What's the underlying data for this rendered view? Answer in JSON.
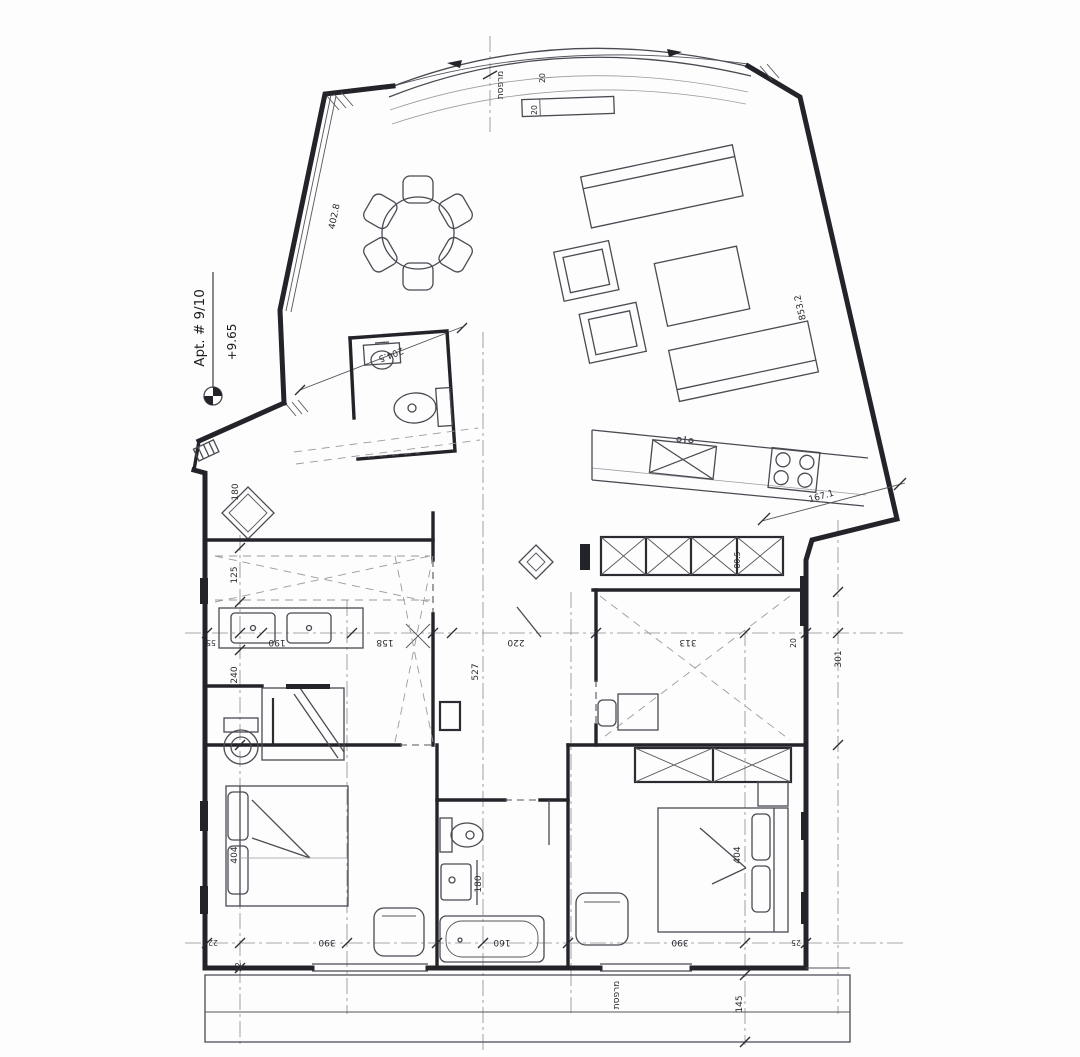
{
  "meta": {
    "paper_color": "#fdfdfd",
    "ink_color": "#23232a",
    "thin_color": "#4a4a52",
    "faint_color": "#9a9aa0"
  },
  "title": {
    "apt_label": "Apt. # 9/10",
    "elevation": "+9.65"
  },
  "labels": {
    "balcony_top": "מרפסת",
    "balcony_top_width": "20",
    "post_width": "20",
    "balcony_bottom": "מרפסת",
    "terrace_edge": "204.5",
    "terrace_wall": "402.8",
    "living_wall": "853.2",
    "kitchen_corner": "167.1",
    "closet_depth": "80.5",
    "d125": "125",
    "d55": "55",
    "d190": "190",
    "d158": "158",
    "d240": "240",
    "d220": "220",
    "d313": "313",
    "d301": "301",
    "d527": "527",
    "d20_wall": "20",
    "d180_entry": "180",
    "d180_bath": "180",
    "d160_tub": "160",
    "d404_left": "404",
    "d390_left": "390",
    "d404_right": "404",
    "d390_right": "390",
    "d145": "145",
    "d25": "25",
    "d22_a": "22",
    "d22_b": "22"
  }
}
